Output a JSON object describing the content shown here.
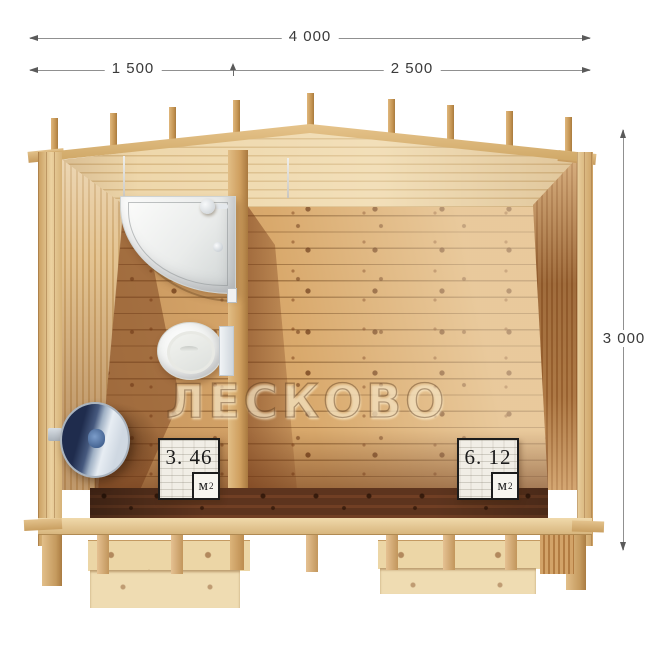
{
  "watermark": {
    "text": "ЛЕСКОВО"
  },
  "dimensions": {
    "width_total": "4 000",
    "width_left": "1 500",
    "width_right": "2 500",
    "depth": "3 000"
  },
  "rooms": {
    "washroom": {
      "area_value": "3. 46",
      "unit": "м",
      "unit_sup": "2"
    },
    "main_room": {
      "area_value": "6. 12",
      "unit": "м",
      "unit_sup": "2"
    }
  },
  "fixtures": {
    "shower": "shower-cabin",
    "toilet": "toilet",
    "heater": "water-heater"
  },
  "colors": {
    "background": "#ffffff",
    "wood_pale": "#ead3a6",
    "wood_honey": "#d9a96c",
    "wood_shadow": "#8a4a22",
    "front_wall_dark": "#713f24",
    "dimension_line": "#909090",
    "dimension_text": "#3a3a3a",
    "heater_navy": "#2f3e63",
    "fixture_white": "#f5f6f4",
    "badge_border": "#1c1c1c"
  }
}
